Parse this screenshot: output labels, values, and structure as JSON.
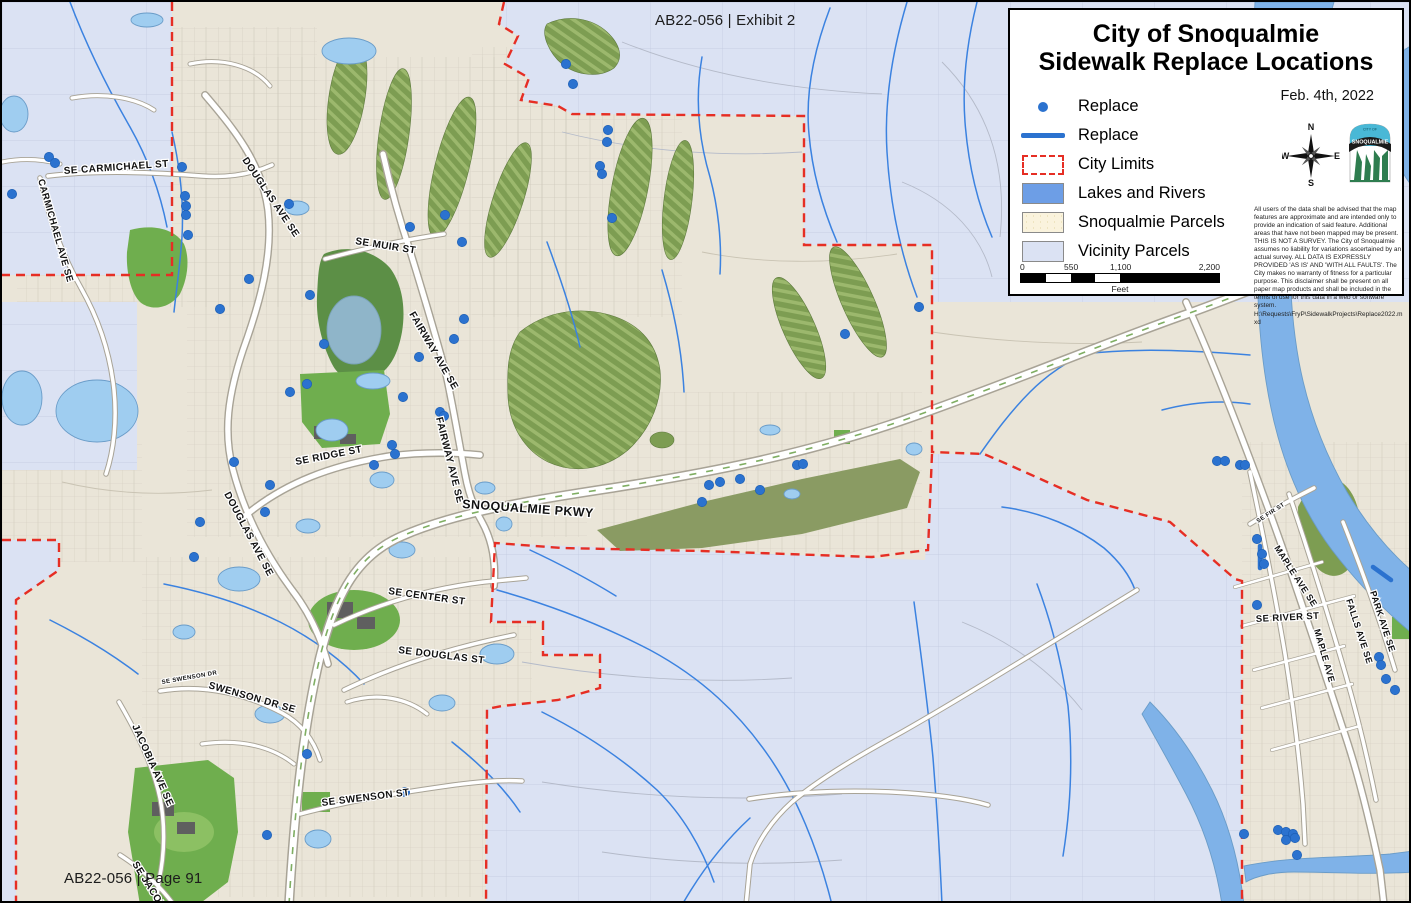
{
  "page": {
    "exhibit_label": "AB22-056 | Exhibit 2",
    "page_label": "AB22-056 | Page 91"
  },
  "legend": {
    "title_line1": "City of Snoqualmie",
    "title_line2": "Sidewalk Replace Locations",
    "date": "Feb. 4th, 2022",
    "items": [
      {
        "label": "Replace",
        "symbol": "point"
      },
      {
        "label": "Replace",
        "symbol": "line"
      },
      {
        "label": "City Limits",
        "symbol": "dashed-box"
      },
      {
        "label": "Lakes and Rivers",
        "symbol": "blue-fill"
      },
      {
        "label": "Snoqualmie Parcels",
        "symbol": "cream-fill"
      },
      {
        "label": "Vicinity Parcels",
        "symbol": "lavender-fill"
      }
    ],
    "compass": {
      "north": "N",
      "east": "E",
      "south": "S",
      "west": "W"
    },
    "logo": {
      "city_of": "CITY OF",
      "name": "SNOQUALMIE"
    },
    "scale_bar": {
      "ticks": [
        "0",
        "550",
        "1,100",
        "2,200"
      ],
      "unit": "Feet"
    },
    "disclaimer": "All users of the data shall be advised that the map features are approximate and are intended only to provide an indication of said feature.  Additional areas that have not been mapped may be present. THIS IS NOT A SURVEY.  The City of Snoqualmie assumes no liability for variations ascertained by an actual survey. ALL DATA IS EXPRESSLY PROVIDED 'AS IS' AND 'WITH ALL FAULTS'. The City makes no warranty of fitness for a particular purpose.  This disclaimer shall be present on all paper map products and shall be included in the terms of use for this data in a web or software system.",
    "file_path": "H:\\Requests\\FryP\\SidewalkProjects\\Replace2022.mxd"
  },
  "map": {
    "street_labels": [
      {
        "text": "SE CARMICHAEL ST",
        "x": 62,
        "y": 172,
        "rot": -4,
        "fs": 10
      },
      {
        "text": "CARMICHAEL AVE SE",
        "x": 36,
        "y": 178,
        "rot": 74,
        "fs": 9.5
      },
      {
        "text": "DOUGLAS AVE SE",
        "x": 240,
        "y": 158,
        "rot": 56,
        "fs": 10
      },
      {
        "text": "SE MUIR ST",
        "x": 353,
        "y": 242,
        "rot": 9,
        "fs": 10
      },
      {
        "text": "FAIRWAY AVE SE",
        "x": 407,
        "y": 312,
        "rot": 60,
        "fs": 10
      },
      {
        "text": "FAIRWAY AVE SE",
        "x": 434,
        "y": 416,
        "rot": 76,
        "fs": 10
      },
      {
        "text": "SE RIDGE ST",
        "x": 294,
        "y": 463,
        "rot": -11,
        "fs": 10
      },
      {
        "text": "DOUGLAS AVE SE",
        "x": 222,
        "y": 492,
        "rot": 62,
        "fs": 10
      },
      {
        "text": "SNOQUALMIE PKWY",
        "x": 460,
        "y": 506,
        "rot": 4,
        "fs": 12.5
      },
      {
        "text": "SE CENTER ST",
        "x": 386,
        "y": 592,
        "rot": 8,
        "fs": 10
      },
      {
        "text": "SE DOUGLAS ST",
        "x": 396,
        "y": 651,
        "rot": 7,
        "fs": 10
      },
      {
        "text": "SE SWENSON DR",
        "x": 160,
        "y": 682,
        "rot": -10,
        "fs": 6
      },
      {
        "text": "SWENSON DR SE",
        "x": 206,
        "y": 686,
        "rot": 16,
        "fs": 10
      },
      {
        "text": "JACOBIA AVE SE",
        "x": 130,
        "y": 724,
        "rot": 66,
        "fs": 10
      },
      {
        "text": "SE SWENSON ST",
        "x": 320,
        "y": 804,
        "rot": -7,
        "fs": 10
      },
      {
        "text": "SE JACOBIA ST",
        "x": 130,
        "y": 862,
        "rot": 58,
        "fs": 10
      },
      {
        "text": "SE FIR ST",
        "x": 1256,
        "y": 521,
        "rot": -33,
        "fs": 6
      },
      {
        "text": "MAPLE AVE SE",
        "x": 1272,
        "y": 546,
        "rot": 57,
        "fs": 9
      },
      {
        "text": "SE RIVER ST",
        "x": 1254,
        "y": 620,
        "rot": -3,
        "fs": 9.5
      },
      {
        "text": "MAPLE AVE",
        "x": 1312,
        "y": 628,
        "rot": 74,
        "fs": 9
      },
      {
        "text": "FALLS AVE SE",
        "x": 1344,
        "y": 598,
        "rot": 72,
        "fs": 9
      },
      {
        "text": "PARK AVE SE",
        "x": 1368,
        "y": 590,
        "rot": 72,
        "fs": 9
      }
    ],
    "replace_points": [
      [
        47,
        155
      ],
      [
        53,
        161
      ],
      [
        10,
        192
      ],
      [
        180,
        165
      ],
      [
        183,
        194
      ],
      [
        184,
        204
      ],
      [
        184,
        213
      ],
      [
        186,
        233
      ],
      [
        287,
        202
      ],
      [
        247,
        277
      ],
      [
        308,
        293
      ],
      [
        218,
        307
      ],
      [
        322,
        342
      ],
      [
        305,
        382
      ],
      [
        288,
        390
      ],
      [
        232,
        460
      ],
      [
        268,
        483
      ],
      [
        263,
        510
      ],
      [
        198,
        520
      ],
      [
        192,
        555
      ],
      [
        564,
        62
      ],
      [
        571,
        82
      ],
      [
        606,
        128
      ],
      [
        605,
        140
      ],
      [
        598,
        164
      ],
      [
        600,
        172
      ],
      [
        610,
        216
      ],
      [
        408,
        225
      ],
      [
        443,
        213
      ],
      [
        460,
        240
      ],
      [
        462,
        317
      ],
      [
        452,
        337
      ],
      [
        417,
        355
      ],
      [
        401,
        395
      ],
      [
        438,
        410
      ],
      [
        442,
        414
      ],
      [
        390,
        443
      ],
      [
        393,
        452
      ],
      [
        372,
        463
      ],
      [
        917,
        305
      ],
      [
        843,
        332
      ],
      [
        700,
        500
      ],
      [
        707,
        483
      ],
      [
        718,
        480
      ],
      [
        738,
        477
      ],
      [
        758,
        488
      ],
      [
        795,
        463
      ],
      [
        801,
        462
      ],
      [
        1215,
        459
      ],
      [
        1223,
        459
      ],
      [
        1238,
        463
      ],
      [
        1243,
        463
      ],
      [
        1255,
        537
      ],
      [
        1260,
        552
      ],
      [
        1262,
        562
      ],
      [
        1255,
        603
      ],
      [
        1377,
        655
      ],
      [
        1379,
        663
      ],
      [
        1384,
        677
      ],
      [
        1393,
        688
      ],
      [
        1242,
        832
      ],
      [
        1276,
        828
      ],
      [
        1284,
        830
      ],
      [
        1291,
        832
      ],
      [
        1293,
        836
      ],
      [
        1284,
        838
      ],
      [
        1295,
        853
      ],
      [
        305,
        752
      ],
      [
        403,
        790
      ],
      [
        265,
        833
      ]
    ],
    "replace_lines": [
      [
        1258,
        544,
        1258,
        566
      ],
      [
        1371,
        565,
        1389,
        578
      ]
    ]
  },
  "colors": {
    "replace_blue": "#2b72cf",
    "city_limits_red": "#e62e24",
    "lakes_and_rivers": "#7fb2e8",
    "snoqualmie_parcels": "#eae5d8",
    "vicinity_parcels": "#dbe2f3",
    "golf_green": "#7d9d52",
    "park_green": "#6fae4e"
  }
}
